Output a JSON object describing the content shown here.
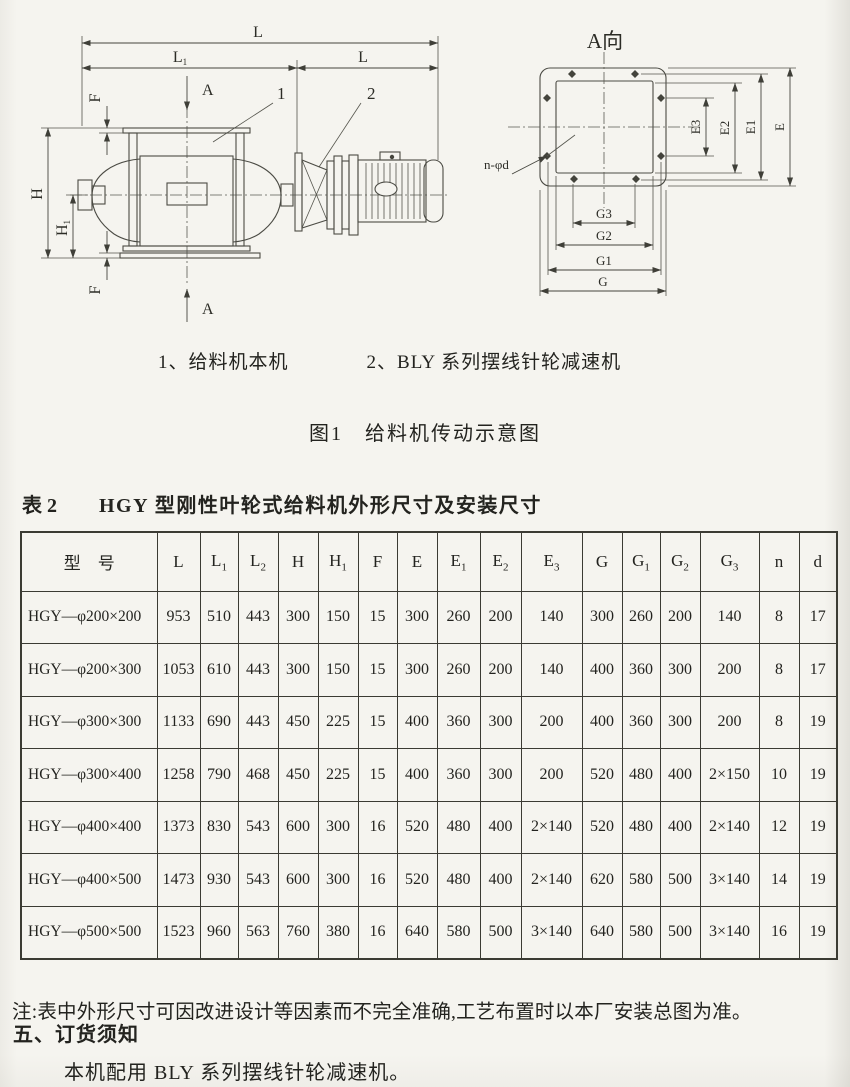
{
  "figure": {
    "side_view": {
      "labels": {
        "dim_L_top": "L",
        "dim_L1_base": "L",
        "dim_L1_sub": "1",
        "dim_L_right": "L",
        "section_A_top": "A",
        "section_A_bottom": "A",
        "dim_H": "H",
        "dim_H1_base": "H",
        "dim_H1_sub": "1",
        "dim_F_top": "F",
        "dim_F_bottom": "F",
        "part_1": "1",
        "part_2": "2"
      }
    },
    "flange_view": {
      "title": "A向",
      "labels": {
        "dim_E": "E",
        "dim_E1": "E1",
        "dim_E2": "E2",
        "dim_E3": "E3",
        "dim_G": "G",
        "dim_G1": "G1",
        "dim_G2": "G2",
        "dim_G3": "G3",
        "holes": "n-φd"
      }
    },
    "legend_item_1": "1、给料机本机",
    "legend_item_2": "2、BLY 系列摆线针轮减速机",
    "caption": "图1　给料机传动示意图"
  },
  "table": {
    "label": "表 2",
    "title": "HGY 型刚性叶轮式给料机外形尺寸及安装尺寸",
    "header": [
      {
        "base": "型　号"
      },
      {
        "base": "L"
      },
      {
        "base": "L",
        "sub": "1"
      },
      {
        "base": "L",
        "sub": "2"
      },
      {
        "base": "H"
      },
      {
        "base": "H",
        "sub": "1"
      },
      {
        "base": "F"
      },
      {
        "base": "E"
      },
      {
        "base": "E",
        "sub": "1"
      },
      {
        "base": "E",
        "sub": "2"
      },
      {
        "base": "E",
        "sub": "3"
      },
      {
        "base": "G"
      },
      {
        "base": "G",
        "sub": "1"
      },
      {
        "base": "G",
        "sub": "2"
      },
      {
        "base": "G",
        "sub": "3"
      },
      {
        "base": "n"
      },
      {
        "base": "d"
      }
    ],
    "rows": [
      [
        "HGY—φ200×200",
        "953",
        "510",
        "443",
        "300",
        "150",
        "15",
        "300",
        "260",
        "200",
        "140",
        "300",
        "260",
        "200",
        "140",
        "8",
        "17"
      ],
      [
        "HGY—φ200×300",
        "1053",
        "610",
        "443",
        "300",
        "150",
        "15",
        "300",
        "260",
        "200",
        "140",
        "400",
        "360",
        "300",
        "200",
        "8",
        "17"
      ],
      [
        "HGY—φ300×300",
        "1133",
        "690",
        "443",
        "450",
        "225",
        "15",
        "400",
        "360",
        "300",
        "200",
        "400",
        "360",
        "300",
        "200",
        "8",
        "19"
      ],
      [
        "HGY—φ300×400",
        "1258",
        "790",
        "468",
        "450",
        "225",
        "15",
        "400",
        "360",
        "300",
        "200",
        "520",
        "480",
        "400",
        "2×150",
        "10",
        "19"
      ],
      [
        "HGY—φ400×400",
        "1373",
        "830",
        "543",
        "600",
        "300",
        "16",
        "520",
        "480",
        "400",
        "2×140",
        "520",
        "480",
        "400",
        "2×140",
        "12",
        "19"
      ],
      [
        "HGY—φ400×500",
        "1473",
        "930",
        "543",
        "600",
        "300",
        "16",
        "520",
        "480",
        "400",
        "2×140",
        "620",
        "580",
        "500",
        "3×140",
        "14",
        "19"
      ],
      [
        "HGY—φ500×500",
        "1523",
        "960",
        "563",
        "760",
        "380",
        "16",
        "640",
        "580",
        "500",
        "3×140",
        "640",
        "580",
        "500",
        "3×140",
        "16",
        "19"
      ]
    ]
  },
  "note": "注:表中外形尺寸可因改进设计等因素而不完全准确,工艺布置时以本厂安装总图为准。",
  "section": {
    "heading": "五、订货须知",
    "body": "本机配用 BLY 系列摆线针轮减速机。"
  }
}
